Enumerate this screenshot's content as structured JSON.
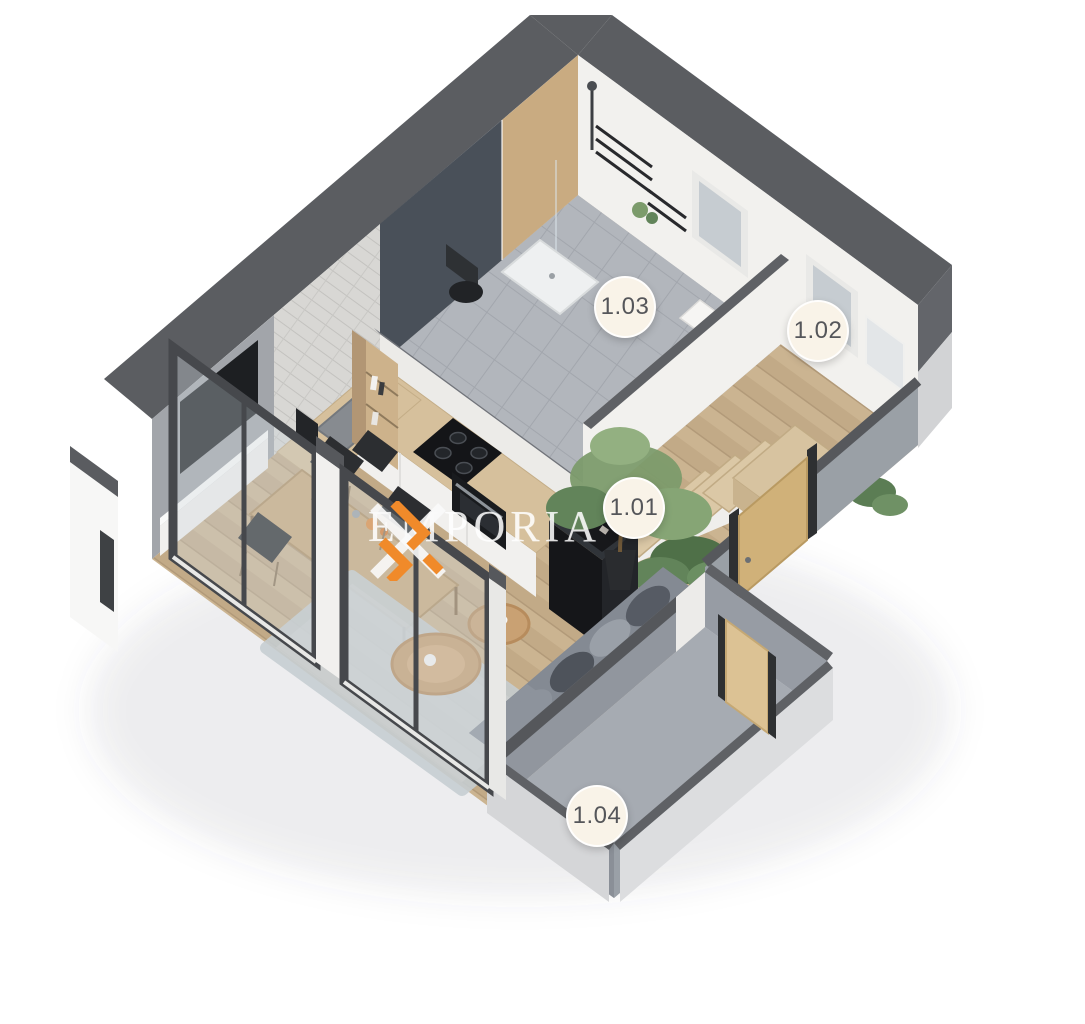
{
  "watermark": {
    "text": "EMPORIA"
  },
  "labels": [
    {
      "text": "1.01",
      "cx": 634,
      "cy": 508
    },
    {
      "text": "1.02",
      "cx": 818,
      "cy": 331
    },
    {
      "text": "1.03",
      "cx": 625,
      "cy": 307
    },
    {
      "text": "1.04",
      "cx": 597,
      "cy": 816
    }
  ],
  "palette": {
    "wall_dark": "#5b5d61",
    "wall_face_white": "#f2f1ee",
    "wall_face_gray": "#a2a5aa",
    "brick": "#d8d7d4",
    "shower_glass": "#39414b",
    "tile": "#b2b6bc",
    "wood_floor": "#cbb491",
    "wood_floor_dark": "#c2aa87",
    "stairs_wood": "#dbc8a6",
    "balcony_floor": "#a6abb2",
    "parapet_inner": "#91969e",
    "parapet_outer": "#dcdddf",
    "counter_wood": "#d6c09c",
    "table_wood": "#c9a97b",
    "appliance_black": "#16171a",
    "chair": "#2c2e31",
    "sofa_seat": "#848a93",
    "sofa_back": "#6d737c",
    "rug": "#cdd4d8",
    "plant": "#7c9b6b",
    "plant_dark": "#62845a",
    "window_frame": "#46484c",
    "glass_front": "rgba(206,214,220,0.35)",
    "door_wood": "#d0b179",
    "label_bg": "#f9f3e8",
    "label_text": "#55565a",
    "accent": "#F08A2A",
    "watermark_text": "rgba(255,255,255,0.82)"
  }
}
